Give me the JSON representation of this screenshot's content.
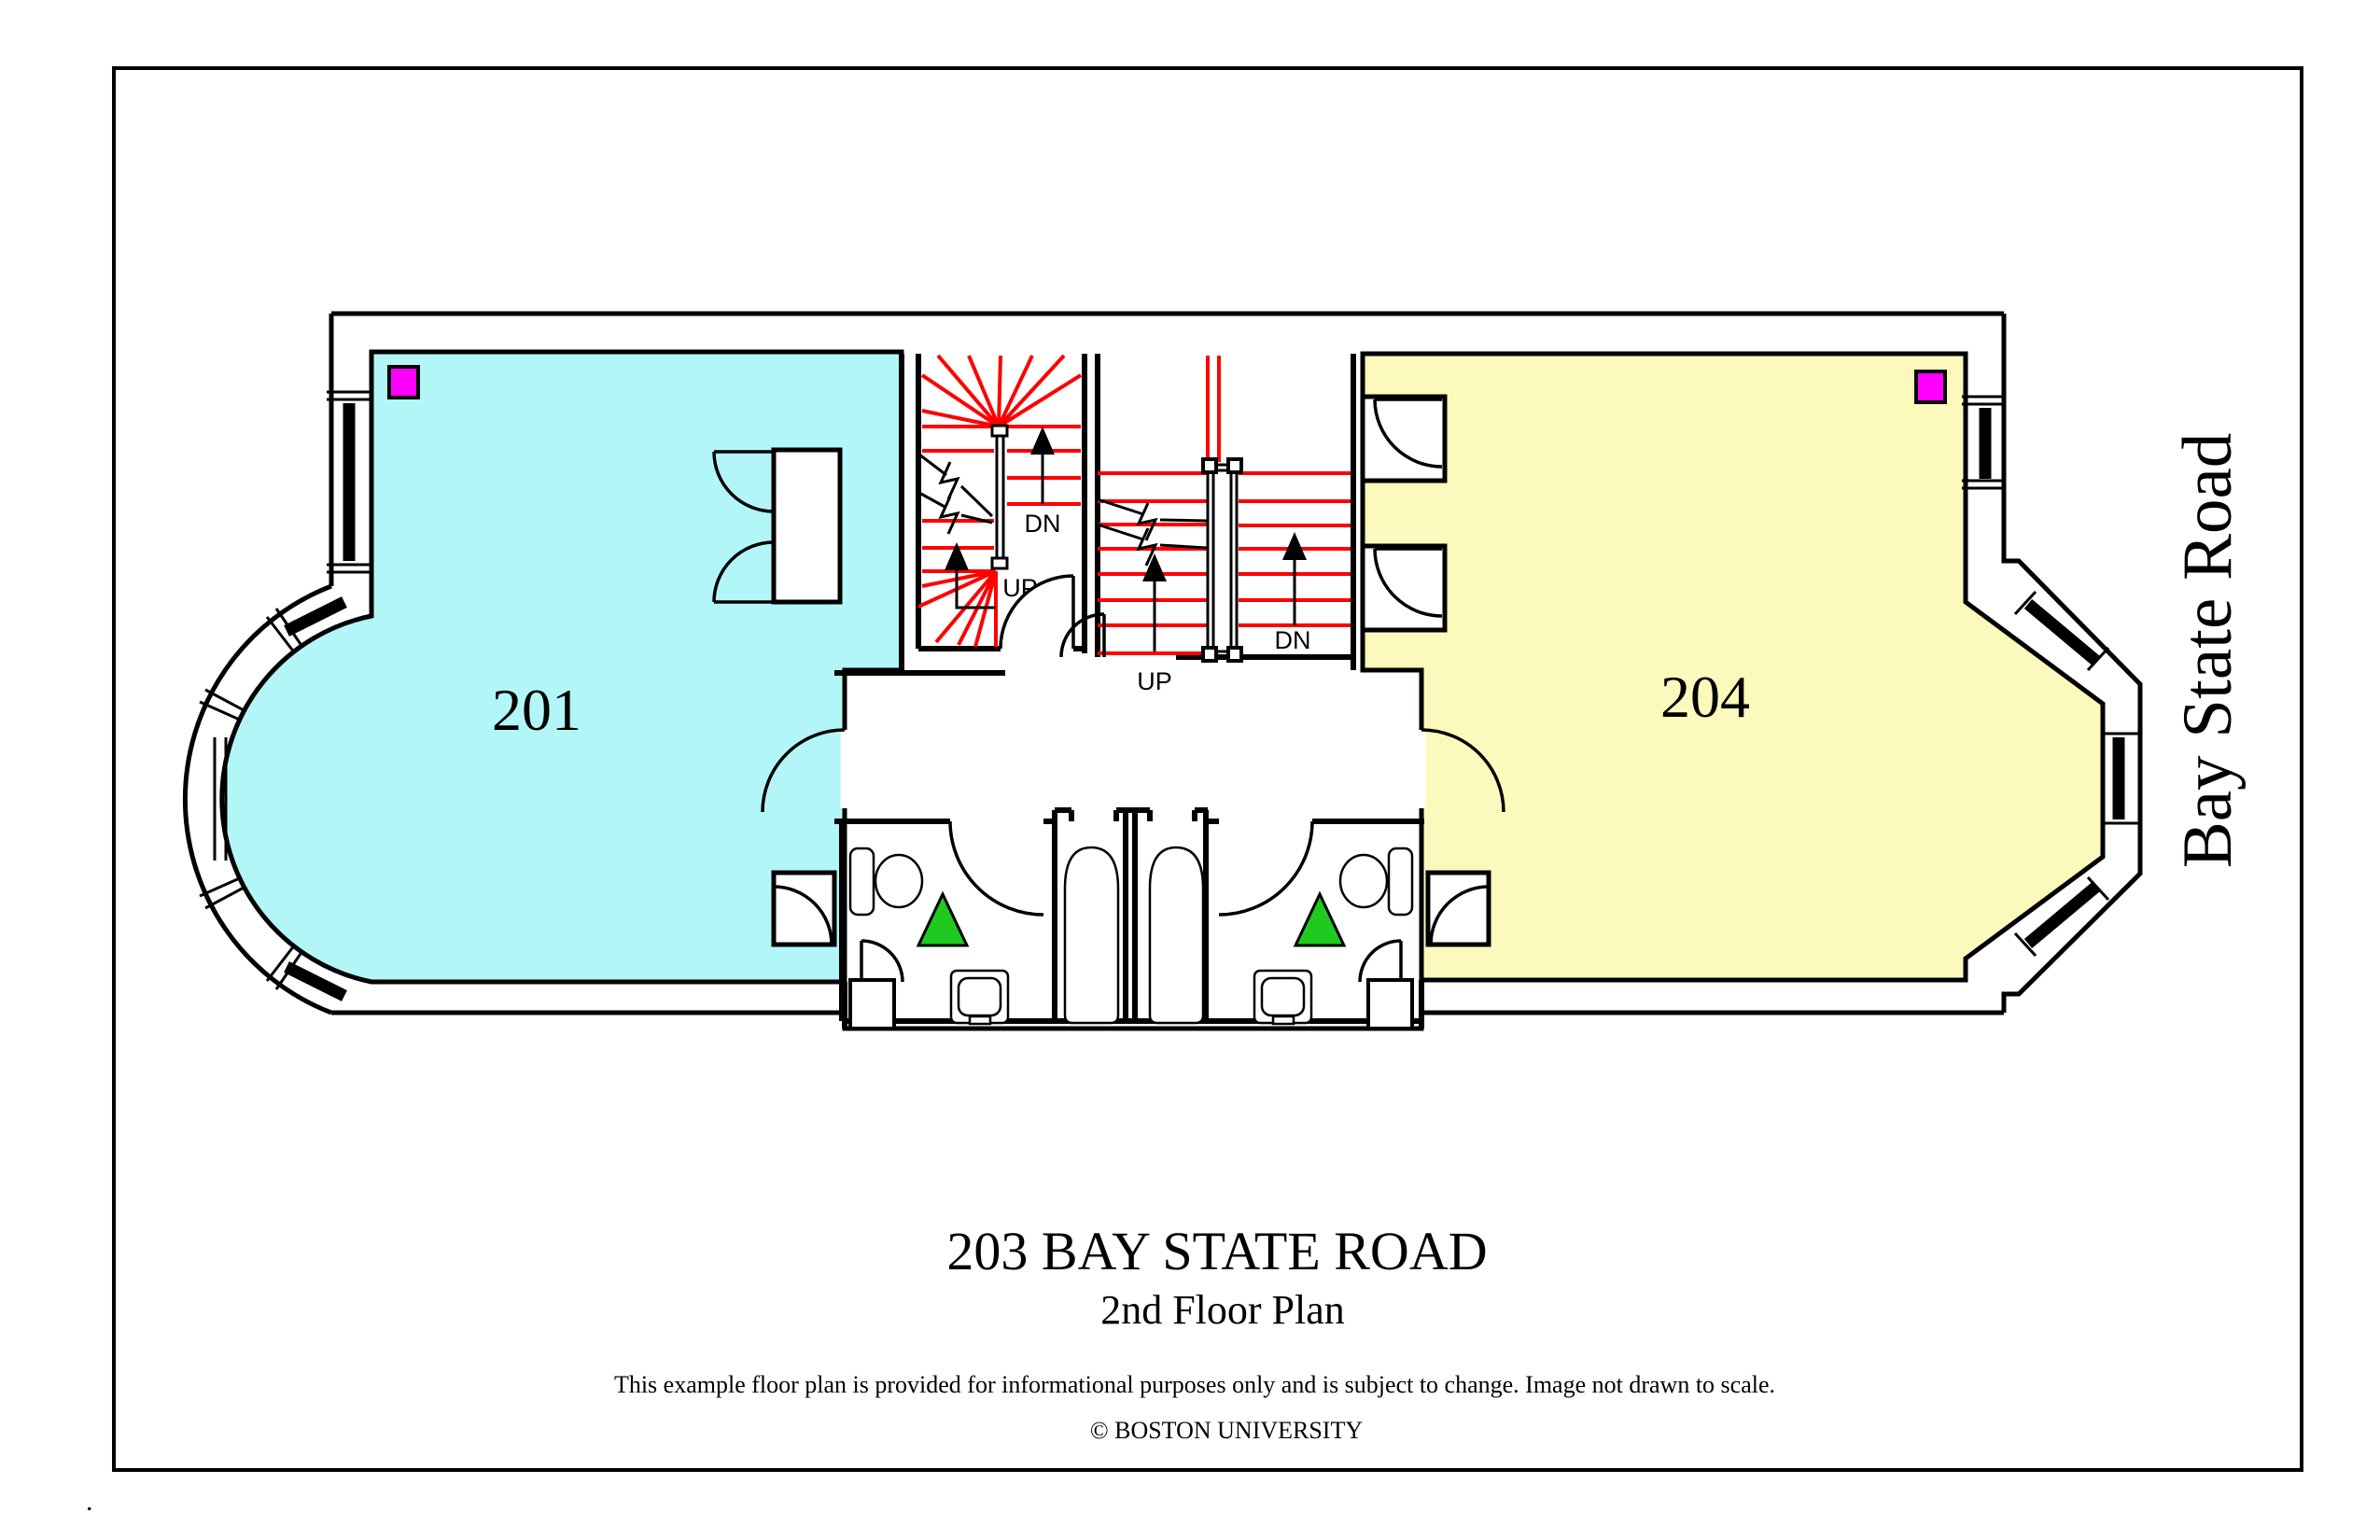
{
  "colors": {
    "room_201_fill": "#B2F6F8",
    "room_204_fill": "#FBF9BC",
    "stair_tread_red": "#FF0000",
    "marker_magenta": "#FF00FF",
    "marker_green": "#1FC91F",
    "line_black": "#000000",
    "page_background": "#FFFFFF"
  },
  "floor_plan": {
    "room_201_label": "201",
    "room_204_label": "204",
    "street_label": "Bay State Road",
    "stair_a": {
      "up": "UP",
      "down": "DN"
    },
    "stair_b": {
      "up": "UP",
      "down": "DN"
    }
  },
  "title_block": {
    "address": "203 BAY STATE ROAD",
    "plan_name": "2nd Floor Plan",
    "disclaimer": "This example floor plan is provided for informational purposes only and is subject to change. Image not drawn to scale.",
    "copyright": "© BOSTON UNIVERSITY"
  },
  "footer": {
    "stray_mark": "."
  }
}
